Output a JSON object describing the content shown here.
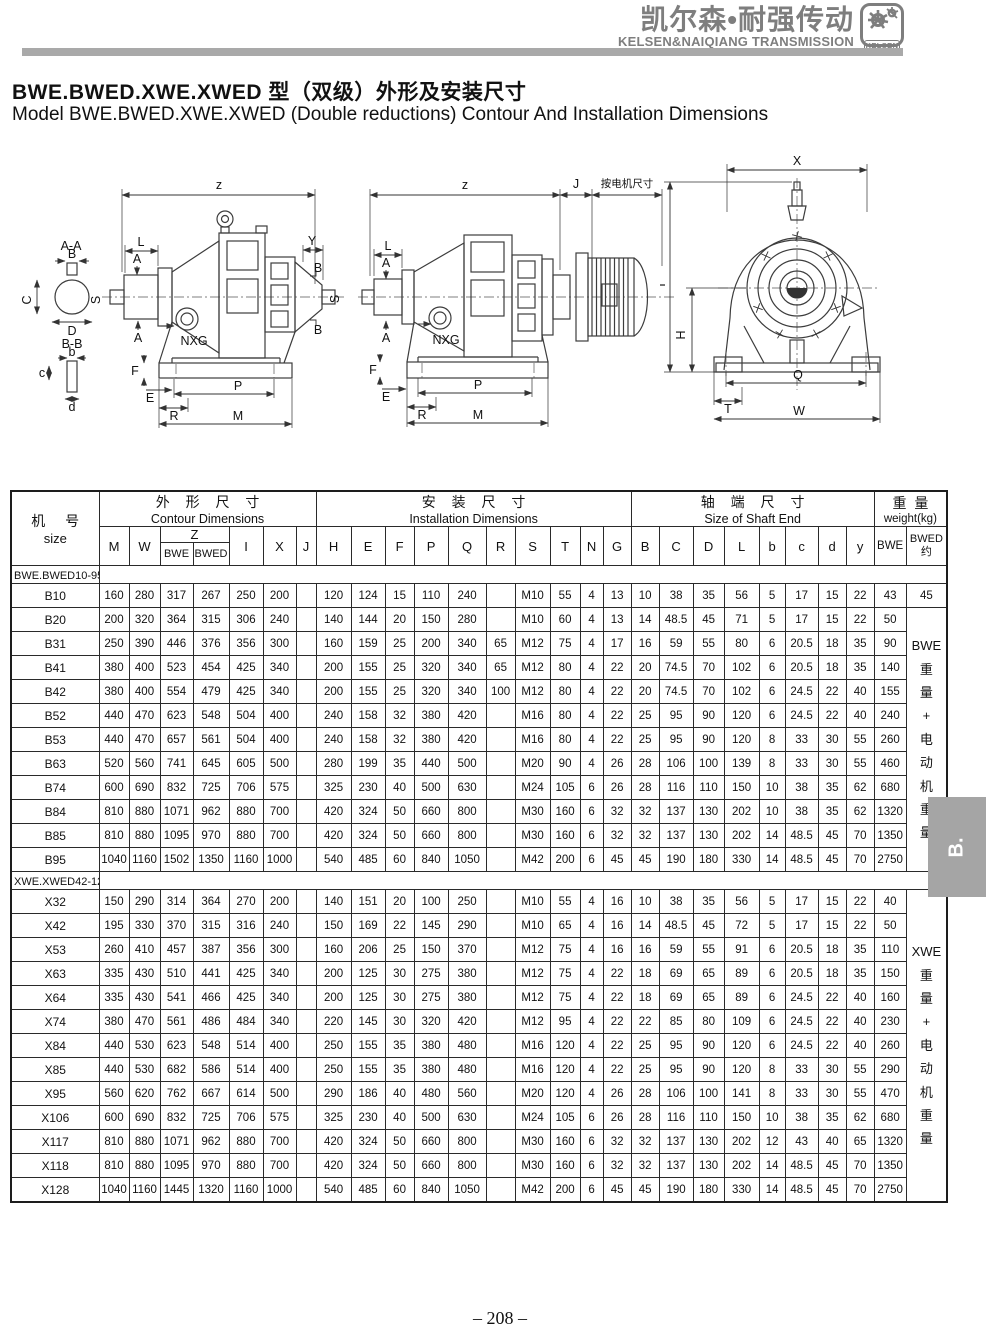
{
  "header": {
    "brand_cn": "凯尔森•耐强传动",
    "brand_en": "KELSEN&NAIQIANG TRANSMISSION",
    "logo_text": "KELSEN"
  },
  "title": {
    "cn": "BWE.BWED.XWE.XWED 型（双级）外形及安装尺寸",
    "en": "Model BWE.BWED.XWE.XWED (Double reductions) Contour And Installation Dimensions"
  },
  "drawings": {
    "left": {
      "z": "z",
      "L": "L",
      "A": "A",
      "Y": "Y",
      "B": "B",
      "S": "S",
      "NXG": "NXG",
      "E": "E",
      "F": "F",
      "P": "P",
      "R": "R",
      "M": "M",
      "sec_aa": "A-A",
      "C": "C",
      "D": "D",
      "sec_bb": "B-B",
      "b": "b",
      "c": "c",
      "d": "d"
    },
    "middle": {
      "z": "z",
      "J": "J",
      "motor_note": "按电机尺寸",
      "L": "L",
      "A": "A",
      "NXG": "NXG",
      "E": "E",
      "F": "F",
      "P": "P",
      "R": "R",
      "M": "M"
    },
    "right": {
      "X": "X",
      "I": "I",
      "H": "H",
      "Q": "Q",
      "T": "T",
      "W": "W"
    }
  },
  "table": {
    "header": {
      "size_cn": "机 号",
      "size_en": "size",
      "groups": [
        {
          "cn": "外 形 尺 寸",
          "en": "Contour Dimensions"
        },
        {
          "cn": "安 装 尺 寸",
          "en": "Installation Dimensions"
        },
        {
          "cn": "轴 端 尺 寸",
          "en": "Size of Shaft End"
        },
        {
          "cn": "重 量",
          "en": "weight(kg)"
        }
      ],
      "letters": [
        "M",
        "W",
        "Z",
        "I",
        "X",
        "J",
        "H",
        "E",
        "F",
        "P",
        "Q",
        "R",
        "S",
        "T",
        "N",
        "G",
        "B",
        "C",
        "D",
        "L",
        "b",
        "c",
        "d",
        "y",
        "BWE",
        "BWED\n约"
      ],
      "z_sub": [
        "BWE",
        "BWED"
      ]
    },
    "sections": [
      {
        "label": "BWE.BWED10-95号",
        "bwed_col": {
          "first_value": "45",
          "span_text": "BWE\n重\n量\n+\n电\n动\n机\n重\n量"
        },
        "rows": [
          {
            "size": "B10",
            "cells": [
              "160",
              "280",
              "317",
              "267",
              "250",
              "200",
              "",
              "120",
              "124",
              "15",
              "110",
              "240",
              "",
              "M10",
              "55",
              "4",
              "13",
              "10",
              "38",
              "35",
              "56",
              "5",
              "17",
              "15",
              "22",
              "43"
            ]
          },
          {
            "size": "B20",
            "cells": [
              "200",
              "320",
              "364",
              "315",
              "306",
              "240",
              "",
              "140",
              "144",
              "20",
              "150",
              "280",
              "",
              "M10",
              "60",
              "4",
              "13",
              "14",
              "48.5",
              "45",
              "71",
              "5",
              "17",
              "15",
              "22",
              "50"
            ]
          },
          {
            "size": "B31",
            "cells": [
              "250",
              "390",
              "446",
              "376",
              "356",
              "300",
              "",
              "160",
              "159",
              "25",
              "200",
              "340",
              "65",
              "M12",
              "75",
              "4",
              "17",
              "16",
              "59",
              "55",
              "80",
              "6",
              "20.5",
              "18",
              "35",
              "90"
            ]
          },
          {
            "size": "B41",
            "cells": [
              "380",
              "400",
              "523",
              "454",
              "425",
              "340",
              "",
              "200",
              "155",
              "25",
              "320",
              "340",
              "65",
              "M12",
              "80",
              "4",
              "22",
              "20",
              "74.5",
              "70",
              "102",
              "6",
              "20.5",
              "18",
              "35",
              "140"
            ]
          },
          {
            "size": "B42",
            "cells": [
              "380",
              "400",
              "554",
              "479",
              "425",
              "340",
              "",
              "200",
              "155",
              "25",
              "320",
              "340",
              "100",
              "M12",
              "80",
              "4",
              "22",
              "20",
              "74.5",
              "70",
              "102",
              "6",
              "24.5",
              "22",
              "40",
              "155"
            ]
          },
          {
            "size": "B52",
            "cells": [
              "440",
              "470",
              "623",
              "548",
              "504",
              "400",
              "",
              "240",
              "158",
              "32",
              "380",
              "420",
              "",
              "M16",
              "80",
              "4",
              "22",
              "25",
              "95",
              "90",
              "120",
              "6",
              "24.5",
              "22",
              "40",
              "240"
            ]
          },
          {
            "size": "B53",
            "cells": [
              "440",
              "470",
              "657",
              "561",
              "504",
              "400",
              "",
              "240",
              "158",
              "32",
              "380",
              "420",
              "",
              "M16",
              "80",
              "4",
              "22",
              "25",
              "95",
              "90",
              "120",
              "8",
              "33",
              "30",
              "55",
              "260"
            ]
          },
          {
            "size": "B63",
            "cells": [
              "520",
              "560",
              "741",
              "645",
              "605",
              "500",
              "",
              "280",
              "199",
              "35",
              "440",
              "500",
              "",
              "M20",
              "90",
              "4",
              "26",
              "28",
              "106",
              "100",
              "139",
              "8",
              "33",
              "30",
              "55",
              "460"
            ]
          },
          {
            "size": "B74",
            "cells": [
              "600",
              "690",
              "832",
              "725",
              "706",
              "575",
              "",
              "325",
              "230",
              "40",
              "500",
              "630",
              "",
              "M24",
              "105",
              "6",
              "26",
              "28",
              "116",
              "110",
              "150",
              "10",
              "38",
              "35",
              "62",
              "680"
            ]
          },
          {
            "size": "B84",
            "cells": [
              "810",
              "880",
              "1071",
              "962",
              "880",
              "700",
              "",
              "420",
              "324",
              "50",
              "660",
              "800",
              "",
              "M30",
              "160",
              "6",
              "32",
              "32",
              "137",
              "130",
              "202",
              "10",
              "38",
              "35",
              "62",
              "1320"
            ]
          },
          {
            "size": "B85",
            "cells": [
              "810",
              "880",
              "1095",
              "970",
              "880",
              "700",
              "",
              "420",
              "324",
              "50",
              "660",
              "800",
              "",
              "M30",
              "160",
              "6",
              "32",
              "32",
              "137",
              "130",
              "202",
              "14",
              "48.5",
              "45",
              "70",
              "1350"
            ]
          },
          {
            "size": "B95",
            "cells": [
              "1040",
              "1160",
              "1502",
              "1350",
              "1160",
              "1000",
              "",
              "540",
              "485",
              "60",
              "840",
              "1050",
              "",
              "M42",
              "200",
              "6",
              "45",
              "45",
              "190",
              "180",
              "330",
              "14",
              "48.5",
              "45",
              "70",
              "2750"
            ]
          }
        ]
      },
      {
        "label": "XWE.XWED42-128号",
        "bwed_col": {
          "span_text": "XWE\n重\n量\n+\n电\n动\n机\n重\n量"
        },
        "rows": [
          {
            "size": "X32",
            "cells": [
              "150",
              "290",
              "314",
              "364",
              "270",
              "200",
              "",
              "140",
              "151",
              "20",
              "100",
              "250",
              "",
              "M10",
              "55",
              "4",
              "16",
              "10",
              "38",
              "35",
              "56",
              "5",
              "17",
              "15",
              "22",
              "40"
            ]
          },
          {
            "size": "X42",
            "cells": [
              "195",
              "330",
              "370",
              "315",
              "316",
              "240",
              "",
              "150",
              "169",
              "22",
              "145",
              "290",
              "",
              "M10",
              "65",
              "4",
              "16",
              "14",
              "48.5",
              "45",
              "72",
              "5",
              "17",
              "15",
              "22",
              "50"
            ]
          },
          {
            "size": "X53",
            "cells": [
              "260",
              "410",
              "457",
              "387",
              "356",
              "300",
              "",
              "160",
              "206",
              "25",
              "150",
              "370",
              "",
              "M12",
              "75",
              "4",
              "16",
              "16",
              "59",
              "55",
              "91",
              "6",
              "20.5",
              "18",
              "35",
              "110"
            ]
          },
          {
            "size": "X63",
            "cells": [
              "335",
              "430",
              "510",
              "441",
              "425",
              "340",
              "",
              "200",
              "125",
              "30",
              "275",
              "380",
              "",
              "M12",
              "75",
              "4",
              "22",
              "18",
              "69",
              "65",
              "89",
              "6",
              "20.5",
              "18",
              "35",
              "150"
            ]
          },
          {
            "size": "X64",
            "cells": [
              "335",
              "430",
              "541",
              "466",
              "425",
              "340",
              "",
              "200",
              "125",
              "30",
              "275",
              "380",
              "",
              "M12",
              "75",
              "4",
              "22",
              "18",
              "69",
              "65",
              "89",
              "6",
              "24.5",
              "22",
              "40",
              "160"
            ]
          },
          {
            "size": "X74",
            "cells": [
              "380",
              "470",
              "561",
              "486",
              "484",
              "340",
              "",
              "220",
              "145",
              "30",
              "320",
              "420",
              "",
              "M12",
              "95",
              "4",
              "22",
              "22",
              "85",
              "80",
              "109",
              "6",
              "24.5",
              "22",
              "40",
              "230"
            ]
          },
          {
            "size": "X84",
            "cells": [
              "440",
              "530",
              "623",
              "548",
              "514",
              "400",
              "",
              "250",
              "155",
              "35",
              "380",
              "480",
              "",
              "M16",
              "120",
              "4",
              "22",
              "25",
              "95",
              "90",
              "120",
              "6",
              "24.5",
              "22",
              "40",
              "260"
            ]
          },
          {
            "size": "X85",
            "cells": [
              "440",
              "530",
              "682",
              "586",
              "514",
              "400",
              "",
              "250",
              "155",
              "35",
              "380",
              "480",
              "",
              "M16",
              "120",
              "4",
              "22",
              "25",
              "95",
              "90",
              "120",
              "8",
              "33",
              "30",
              "55",
              "290"
            ]
          },
          {
            "size": "X95",
            "cells": [
              "560",
              "620",
              "762",
              "667",
              "614",
              "500",
              "",
              "290",
              "186",
              "40",
              "480",
              "560",
              "",
              "M20",
              "120",
              "4",
              "26",
              "28",
              "106",
              "100",
              "141",
              "8",
              "33",
              "30",
              "55",
              "470"
            ]
          },
          {
            "size": "X106",
            "cells": [
              "600",
              "690",
              "832",
              "725",
              "706",
              "575",
              "",
              "325",
              "230",
              "40",
              "500",
              "630",
              "",
              "M24",
              "105",
              "6",
              "26",
              "28",
              "116",
              "110",
              "150",
              "10",
              "38",
              "35",
              "62",
              "680"
            ]
          },
          {
            "size": "X117",
            "cells": [
              "810",
              "880",
              "1071",
              "962",
              "880",
              "700",
              "",
              "420",
              "324",
              "50",
              "660",
              "800",
              "",
              "M30",
              "160",
              "6",
              "32",
              "32",
              "137",
              "130",
              "202",
              "12",
              "43",
              "40",
              "65",
              "1320"
            ]
          },
          {
            "size": "X118",
            "cells": [
              "810",
              "880",
              "1095",
              "970",
              "880",
              "700",
              "",
              "420",
              "324",
              "50",
              "660",
              "800",
              "",
              "M30",
              "160",
              "6",
              "32",
              "32",
              "137",
              "130",
              "202",
              "14",
              "48.5",
              "45",
              "70",
              "1350"
            ]
          },
          {
            "size": "X128",
            "cells": [
              "1040",
              "1160",
              "1445",
              "1320",
              "1160",
              "1000",
              "",
              "540",
              "485",
              "60",
              "840",
              "1050",
              "",
              "M42",
              "200",
              "6",
              "45",
              "45",
              "190",
              "180",
              "330",
              "14",
              "48.5",
              "45",
              "70",
              "2750"
            ]
          }
        ]
      }
    ]
  },
  "side_tab": {
    "label": "B."
  },
  "footer": {
    "page_number": "– 208 –"
  }
}
